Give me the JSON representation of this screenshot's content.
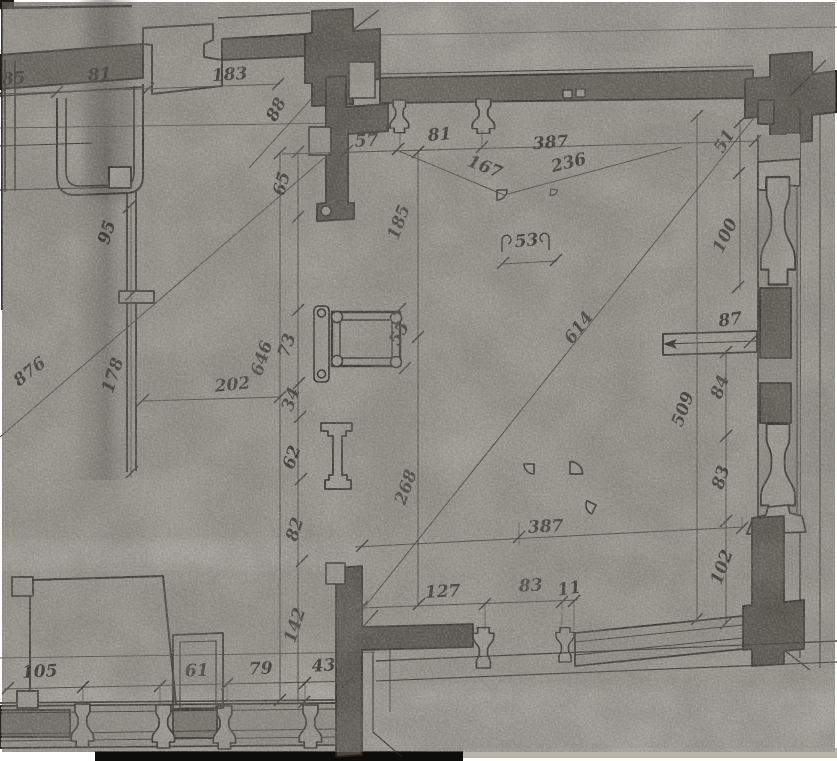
{
  "drawing": {
    "dimension_labels": [
      "85",
      "81",
      "183",
      "88",
      "57",
      "81",
      "387",
      "167",
      "236",
      "51",
      "65",
      "185",
      "95",
      "100",
      "53",
      "876",
      "178",
      "202",
      "646",
      "73",
      "55",
      "614",
      "87",
      "34",
      "84",
      "509",
      "62",
      "268",
      "83",
      "82",
      "387",
      "102",
      "127",
      "83",
      "11",
      "142",
      "105",
      "61",
      "79",
      "43"
    ],
    "colors": {
      "paper": "#a5a29a",
      "paper_light": "#b3b0a8",
      "ink": "#21201c",
      "wall_fill": "#5d5a52",
      "column_fill": "#4a4740",
      "profile_fill": "#a9a69e",
      "scan_bar": "#0d0d0c"
    }
  }
}
